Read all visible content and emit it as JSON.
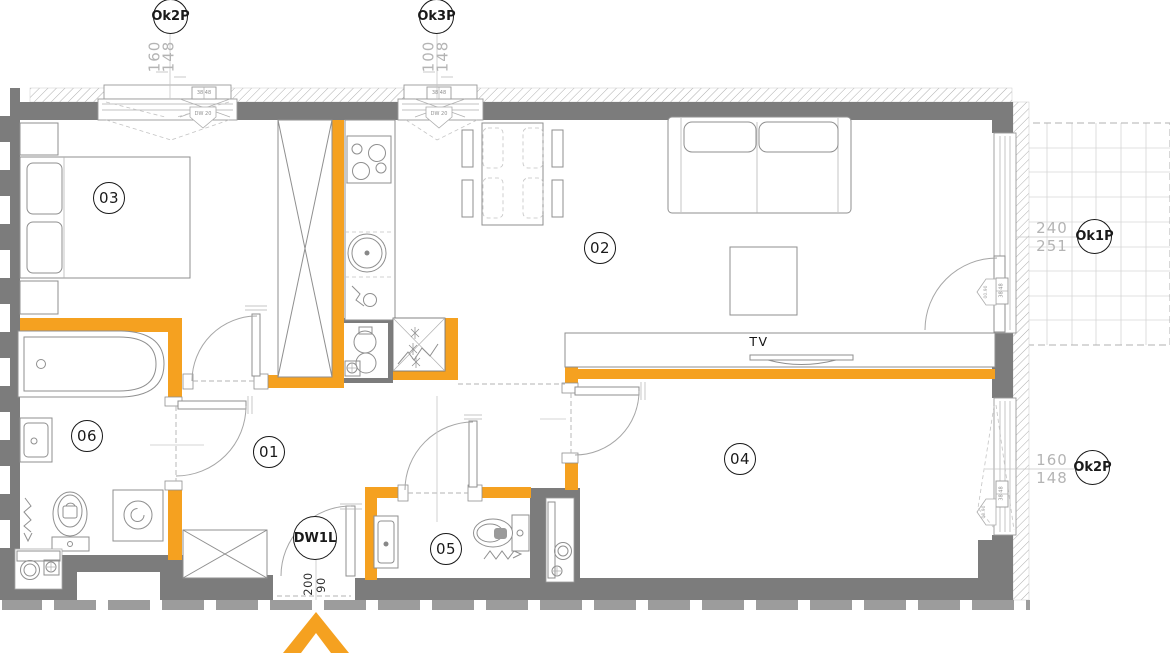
{
  "colors": {
    "orange": "#F5A120",
    "wall": "#7C7C7C",
    "dim": "#B4B4B4",
    "ink": "#1A1A1A"
  },
  "rooms": [
    {
      "number": "01"
    },
    {
      "number": "02"
    },
    {
      "number": "03"
    },
    {
      "number": "04"
    },
    {
      "number": "05"
    },
    {
      "number": "06"
    }
  ],
  "window_tags": [
    {
      "label": "Ok2P",
      "dim_a": "160",
      "dim_b": "148"
    },
    {
      "label": "Ok3P",
      "dim_a": "100",
      "dim_b": "148"
    },
    {
      "label": "Ok1P",
      "dim_a": "240",
      "dim_b": "251"
    },
    {
      "label": "Ok2P",
      "dim_a": "160",
      "dim_b": "148"
    }
  ],
  "entrance_door": {
    "label": "DW1L",
    "dim_a": "200",
    "dim_b": "90"
  },
  "living_room": {
    "tv_label": "TV"
  },
  "annotations": {
    "sill": "38 48",
    "window_marker": "DW 20",
    "level_marker": "00.90"
  }
}
